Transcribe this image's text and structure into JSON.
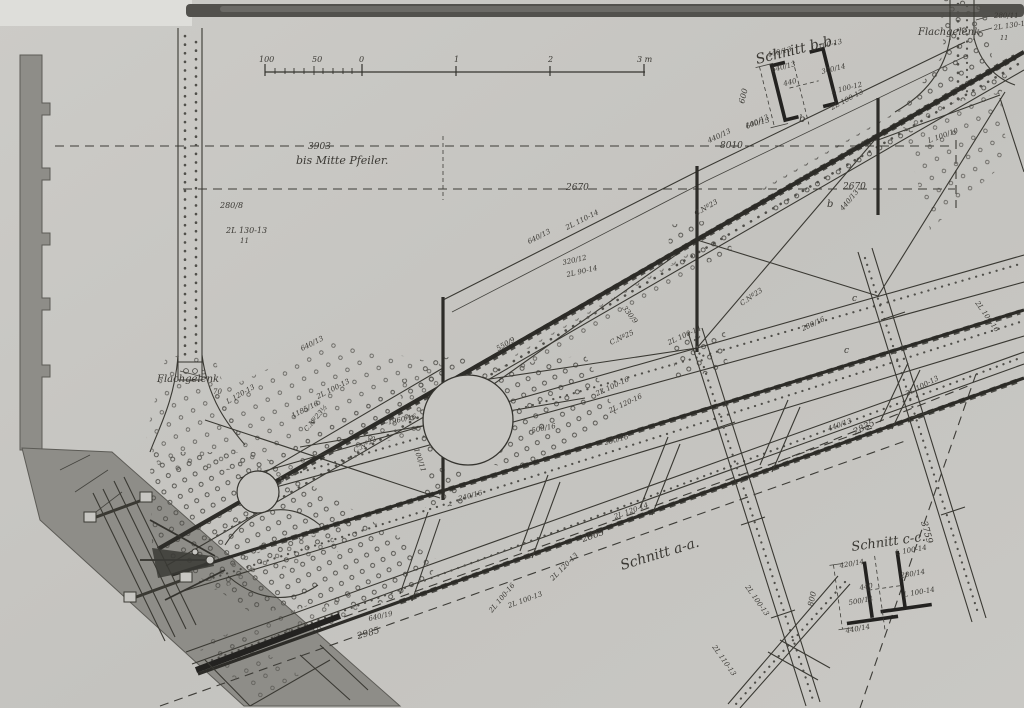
{
  "drawing": {
    "kind": "riveted steel truss engineering drawing (bascule bridge arm with sections)",
    "colors": {
      "paper": "#c7c6c2",
      "ink": "#35342f",
      "heavy_ink": "#2b2a26",
      "masonry": "#8e8d88",
      "top_band": "#52514d"
    },
    "annotations": [
      {
        "name": "dim-3903",
        "text": "3903",
        "x": 308,
        "y": 149,
        "r": 0,
        "s": 9
      },
      {
        "name": "note-bis-mitte-pfeiler",
        "text": "bis Mitte Pfeiler.",
        "x": 296,
        "y": 164,
        "r": 0,
        "s": 11
      },
      {
        "name": "dim-8010",
        "text": "8010",
        "x": 720,
        "y": 148,
        "r": 0,
        "s": 9
      },
      {
        "name": "dim-2670-a",
        "text": "2670",
        "x": 566,
        "y": 190,
        "r": 0,
        "s": 9
      },
      {
        "name": "dim-2670-b",
        "text": "2670",
        "x": 843,
        "y": 189,
        "r": 0,
        "s": 9
      },
      {
        "name": "dim-2865",
        "text": "2865",
        "x": 583,
        "y": 542,
        "r": -19,
        "s": 9
      },
      {
        "name": "section-title-a",
        "text": "Schnitt a-a.",
        "x": 622,
        "y": 570,
        "r": -17,
        "s": 14
      },
      {
        "name": "dim-2985",
        "text": "2985",
        "x": 358,
        "y": 639,
        "r": -16,
        "s": 9
      },
      {
        "name": "dim-2835",
        "text": "2835",
        "x": 855,
        "y": 435,
        "r": -27,
        "s": 9
      },
      {
        "name": "dim-3759",
        "text": "3759",
        "x": 921,
        "y": 522,
        "r": 74,
        "s": 9
      },
      {
        "name": "section-title-b",
        "text": "Schnitt b-b.",
        "x": 757,
        "y": 64,
        "r": -14,
        "s": 14
      },
      {
        "name": "section-title-c",
        "text": "Schnitt c-c.",
        "x": 852,
        "y": 551,
        "r": -8,
        "s": 13
      },
      {
        "name": "note-flachgelenk-left",
        "text": "Flachgelenk",
        "x": 157,
        "y": 382,
        "r": 0,
        "s": 10
      },
      {
        "name": "note-flachgelenk-top",
        "text": "Flachgelenk",
        "x": 918,
        "y": 35,
        "r": 0,
        "s": 10
      },
      {
        "name": "scale-100",
        "text": "100",
        "x": 259,
        "y": 62,
        "r": 0,
        "s": 8
      },
      {
        "name": "scale-50",
        "text": "50",
        "x": 312,
        "y": 62,
        "r": 0,
        "s": 8
      },
      {
        "name": "scale-0",
        "text": "0",
        "x": 359,
        "y": 62,
        "r": 0,
        "s": 8
      },
      {
        "name": "scale-1",
        "text": "1",
        "x": 454,
        "y": 62,
        "r": 0,
        "s": 8
      },
      {
        "name": "scale-2",
        "text": "2",
        "x": 548,
        "y": 62,
        "r": 0,
        "s": 8
      },
      {
        "name": "scale-3m",
        "text": "3 m",
        "x": 637,
        "y": 62,
        "r": 0,
        "s": 8
      },
      {
        "name": "member-label",
        "text": "280/8",
        "x": 220,
        "y": 208,
        "r": 0,
        "s": 8
      },
      {
        "name": "member-label",
        "text": "2L 130-13",
        "x": 226,
        "y": 233,
        "r": 0,
        "s": 8
      },
      {
        "name": "member-label",
        "text": "11",
        "x": 240,
        "y": 243,
        "r": 0,
        "s": 7
      },
      {
        "name": "member-label",
        "text": "280/11",
        "x": 994,
        "y": 18,
        "r": 0,
        "s": 7
      },
      {
        "name": "member-label",
        "text": "2L 130-13",
        "x": 994,
        "y": 30,
        "r": -8,
        "s": 7
      },
      {
        "name": "member-label",
        "text": "11",
        "x": 1000,
        "y": 40,
        "r": 0,
        "s": 6.5
      },
      {
        "name": "dim-label",
        "text": "440/13",
        "x": 768,
        "y": 57,
        "r": -14,
        "s": 7
      },
      {
        "name": "member-label",
        "text": "L 100-13",
        "x": 812,
        "y": 51,
        "r": -14,
        "s": 7
      },
      {
        "name": "dim-label",
        "text": "640/13",
        "x": 772,
        "y": 72,
        "r": -14,
        "s": 7
      },
      {
        "name": "member-label",
        "text": "300/14",
        "x": 822,
        "y": 74,
        "r": -14,
        "s": 7
      },
      {
        "name": "member-label",
        "text": "L 100-12",
        "x": 832,
        "y": 94,
        "r": -14,
        "s": 7
      },
      {
        "name": "dim-label",
        "text": "600",
        "x": 744,
        "y": 104,
        "r": -76,
        "s": 8
      },
      {
        "name": "dim-label",
        "text": "440",
        "x": 784,
        "y": 86,
        "r": -14,
        "s": 7
      },
      {
        "name": "dim-label",
        "text": "100/13",
        "x": 746,
        "y": 128,
        "r": -14,
        "s": 7
      },
      {
        "name": "section-mark",
        "text": "b",
        "x": 799,
        "y": 122,
        "r": 0,
        "s": 10
      },
      {
        "name": "section-mark",
        "text": "b",
        "x": 827,
        "y": 207,
        "r": 0,
        "s": 10
      },
      {
        "name": "dim-label",
        "text": "420/14",
        "x": 840,
        "y": 568,
        "r": -10,
        "s": 7
      },
      {
        "name": "member-label",
        "text": "L 100-14",
        "x": 896,
        "y": 555,
        "r": -10,
        "s": 7
      },
      {
        "name": "member-label",
        "text": "280/14",
        "x": 901,
        "y": 578,
        "r": -10,
        "s": 7
      },
      {
        "name": "member-label",
        "text": "L 100-14",
        "x": 904,
        "y": 597,
        "r": -10,
        "s": 7
      },
      {
        "name": "dim-label",
        "text": "800",
        "x": 813,
        "y": 607,
        "r": -78,
        "s": 8
      },
      {
        "name": "dim-label",
        "text": "440",
        "x": 860,
        "y": 590,
        "r": -10,
        "s": 7
      },
      {
        "name": "dim-label",
        "text": "500/14",
        "x": 849,
        "y": 605,
        "r": -10,
        "s": 7
      },
      {
        "name": "dim-label",
        "text": "440/14",
        "x": 846,
        "y": 633,
        "r": -10,
        "s": 7
      },
      {
        "name": "member-label",
        "text": "L 120-13",
        "x": 228,
        "y": 404,
        "r": -30,
        "s": 7
      },
      {
        "name": "dim-label",
        "text": "70",
        "x": 213,
        "y": 394,
        "r": 0,
        "s": 7
      },
      {
        "name": "member-label",
        "text": "2L 100-13",
        "x": 318,
        "y": 399,
        "r": -27,
        "s": 7
      },
      {
        "name": "dim-label",
        "text": "640/13",
        "x": 302,
        "y": 351,
        "r": -27,
        "s": 7
      },
      {
        "name": "dim-label",
        "text": "1185/16",
        "x": 293,
        "y": 418,
        "r": -27,
        "s": 7
      },
      {
        "name": "member-label",
        "text": "C.Nº23½",
        "x": 307,
        "y": 432,
        "r": -50,
        "s": 7
      },
      {
        "name": "member-label",
        "text": "C.Nº22",
        "x": 355,
        "y": 453,
        "r": -30,
        "s": 7
      },
      {
        "name": "dim-label",
        "text": "-1960/16",
        "x": 386,
        "y": 425,
        "r": -12,
        "s": 7
      },
      {
        "name": "dim-label",
        "text": "100/11",
        "x": 414,
        "y": 449,
        "r": 72,
        "s": 7
      },
      {
        "name": "member-label",
        "text": "C.Nº23",
        "x": 696,
        "y": 216,
        "r": -30,
        "s": 7
      },
      {
        "name": "member-label",
        "text": "C.Nº23",
        "x": 742,
        "y": 306,
        "r": -35,
        "s": 7
      },
      {
        "name": "member-label",
        "text": "C.Nº25",
        "x": 611,
        "y": 345,
        "r": -25,
        "s": 7
      },
      {
        "name": "dim-label",
        "text": "550/9",
        "x": 498,
        "y": 351,
        "r": -30,
        "s": 7
      },
      {
        "name": "member-label",
        "text": "2L 110-14",
        "x": 567,
        "y": 230,
        "r": -27,
        "s": 7
      },
      {
        "name": "dim-label",
        "text": "640/13",
        "x": 529,
        "y": 244,
        "r": -27,
        "s": 7
      },
      {
        "name": "dim-label",
        "text": "320/12",
        "x": 563,
        "y": 265,
        "r": -13,
        "s": 7
      },
      {
        "name": "member-label",
        "text": "2L 90-14",
        "x": 567,
        "y": 277,
        "r": -13,
        "s": 7
      },
      {
        "name": "dim-label",
        "text": "330/9",
        "x": 622,
        "y": 308,
        "r": 52,
        "s": 7
      },
      {
        "name": "member-label",
        "text": "2L 100-13",
        "x": 832,
        "y": 110,
        "r": -28,
        "s": 7
      },
      {
        "name": "dim-label",
        "text": "440/13",
        "x": 709,
        "y": 143,
        "r": -25,
        "s": 7
      },
      {
        "name": "dim-label",
        "text": "640/13",
        "x": 747,
        "y": 129,
        "r": -25,
        "s": 7
      },
      {
        "name": "dim-label",
        "text": "500/16",
        "x": 532,
        "y": 433,
        "r": -12,
        "s": 7
      },
      {
        "name": "dim-label",
        "text": "280/16",
        "x": 605,
        "y": 445,
        "r": -15,
        "s": 7
      },
      {
        "name": "dim-label",
        "text": "280/16",
        "x": 803,
        "y": 331,
        "r": -25,
        "s": 7
      },
      {
        "name": "member-label",
        "text": "2L 100-16",
        "x": 597,
        "y": 396,
        "r": -25,
        "s": 7
      },
      {
        "name": "member-label",
        "text": "2L 120-16",
        "x": 610,
        "y": 413,
        "r": -25,
        "s": 7
      },
      {
        "name": "member-label",
        "text": "2L 100-14",
        "x": 669,
        "y": 345,
        "r": -25,
        "s": 7
      },
      {
        "name": "member-label",
        "text": "L 100/10",
        "x": 929,
        "y": 143,
        "r": -20,
        "s": 7
      },
      {
        "name": "member-label",
        "text": "2L 100-13",
        "x": 907,
        "y": 396,
        "r": -27,
        "s": 7
      },
      {
        "name": "dim-label",
        "text": "440/13",
        "x": 829,
        "y": 431,
        "r": -20,
        "s": 7
      },
      {
        "name": "dim-label",
        "text": "440/13",
        "x": 843,
        "y": 211,
        "r": -50,
        "s": 7
      },
      {
        "name": "member-label",
        "text": "2L 120-14",
        "x": 615,
        "y": 519,
        "r": -20,
        "s": 7
      },
      {
        "name": "member-label",
        "text": "2L 120-13",
        "x": 553,
        "y": 581,
        "r": -45,
        "s": 7
      },
      {
        "name": "member-label",
        "text": "2L 100-13",
        "x": 509,
        "y": 608,
        "r": -20,
        "s": 7
      },
      {
        "name": "dim-label",
        "text": "640/19",
        "x": 369,
        "y": 621,
        "r": -13,
        "s": 7
      },
      {
        "name": "member-label",
        "text": "2L 100-16",
        "x": 492,
        "y": 613,
        "r": -50,
        "s": 7
      },
      {
        "name": "member-label",
        "text": "2L 100-13",
        "x": 745,
        "y": 587,
        "r": 55,
        "s": 7
      },
      {
        "name": "member-label",
        "text": "2L 110-13",
        "x": 712,
        "y": 647,
        "r": 55,
        "s": 7
      },
      {
        "name": "member-label",
        "text": "2L 100-16",
        "x": 975,
        "y": 303,
        "r": 55,
        "s": 7
      },
      {
        "name": "dim-label",
        "text": "240/16",
        "x": 459,
        "y": 501,
        "r": -15,
        "s": 7
      },
      {
        "name": "section-mark",
        "text": "c",
        "x": 852,
        "y": 301,
        "r": 0,
        "s": 9
      },
      {
        "name": "section-mark",
        "text": "c",
        "x": 844,
        "y": 353,
        "r": 0,
        "s": 9
      }
    ]
  }
}
